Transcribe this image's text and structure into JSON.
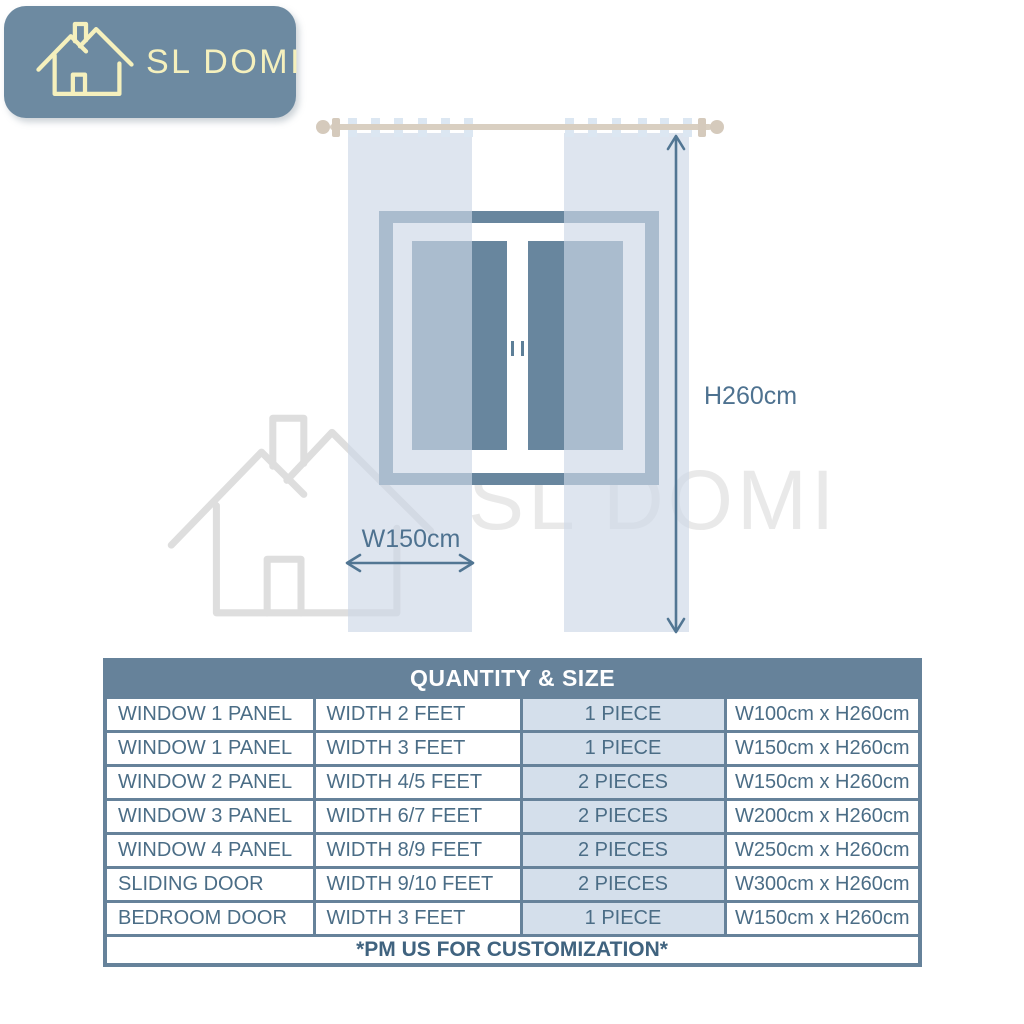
{
  "brand": {
    "logo_text": "SL DOMI",
    "watermark_text": "SL DOMI"
  },
  "colors": {
    "badge_background": "#6d8aa1",
    "logo_cream": "#f5f0bd",
    "window_slate": "#68869e",
    "curtain_light_blue": "#dce7f2",
    "rod_beige": "#d9cfc1",
    "arrow_slate": "#527693",
    "table_border": "#66829a",
    "quantity_cell_background": "#d4dfeb",
    "watermark_gray": "#e9e9e9"
  },
  "diagram": {
    "height_label": "H260cm",
    "width_label": "W150cm"
  },
  "table": {
    "title": "QUANTITY & SIZE",
    "rows": [
      [
        "WINDOW 1 PANEL",
        "WIDTH 2 FEET",
        "1 PIECE",
        "W100cm x H260cm"
      ],
      [
        "WINDOW 1 PANEL",
        "WIDTH 3 FEET",
        "1 PIECE",
        "W150cm x H260cm"
      ],
      [
        "WINDOW 2 PANEL",
        "WIDTH 4/5 FEET",
        "2 PIECES",
        "W150cm x H260cm"
      ],
      [
        "WINDOW 3 PANEL",
        "WIDTH 6/7 FEET",
        "2 PIECES",
        "W200cm x H260cm"
      ],
      [
        "WINDOW 4 PANEL",
        "WIDTH 8/9 FEET",
        "2 PIECES",
        "W250cm x H260cm"
      ],
      [
        "SLIDING DOOR",
        "WIDTH 9/10 FEET",
        "2 PIECES",
        "W300cm x H260cm"
      ],
      [
        "BEDROOM DOOR",
        "WIDTH 3 FEET",
        "1 PIECE",
        "W150cm x H260cm"
      ]
    ],
    "footer": "*PM US FOR CUSTOMIZATION*"
  }
}
